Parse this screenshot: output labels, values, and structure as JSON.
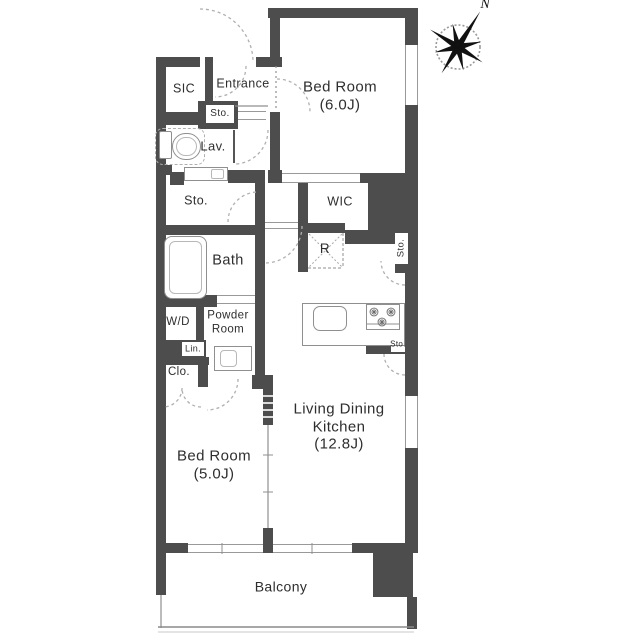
{
  "title": "apartment-floor-plan",
  "colors": {
    "wall": "#4d4d4d",
    "line": "#8f8f8f",
    "dash": "#b0b0b0",
    "text": "#2e2e2e"
  },
  "compass": {
    "cx": 458,
    "cy": 47,
    "r": 22,
    "label": "N",
    "points": [
      {
        "a": -58,
        "len": 42
      },
      {
        "a": -13,
        "len": 24
      },
      {
        "a": 32,
        "len": 29
      },
      {
        "a": 77,
        "len": 24
      },
      {
        "a": 122,
        "len": 31
      },
      {
        "a": 167,
        "len": 24
      },
      {
        "a": 212,
        "len": 33
      },
      {
        "a": 257,
        "len": 24
      }
    ],
    "half_width": 3.4
  },
  "labels": [
    {
      "name": "label-sic",
      "text": "SIC",
      "x": 184,
      "y": 89,
      "size": 12.5
    },
    {
      "name": "label-entrance",
      "text": "Entrance",
      "x": 243,
      "y": 84,
      "size": 12.5
    },
    {
      "name": "label-sto-entrance",
      "text": "Sto.",
      "x": 220,
      "y": 114,
      "size": 10
    },
    {
      "name": "label-lav",
      "text": "Lav.",
      "x": 213,
      "y": 146,
      "size": 13
    },
    {
      "name": "label-bedroom6",
      "text": "Bed Room\n(6.0J)",
      "x": 340,
      "y": 96,
      "size": 15
    },
    {
      "name": "label-sto-hall",
      "text": "Sto.",
      "x": 196,
      "y": 201,
      "size": 12.5
    },
    {
      "name": "label-wic",
      "text": "WIC",
      "x": 340,
      "y": 202,
      "size": 12.5
    },
    {
      "name": "label-refrigerator",
      "text": "R",
      "x": 325,
      "y": 249,
      "size": 13.5
    },
    {
      "name": "label-bath",
      "text": "Bath",
      "x": 228,
      "y": 261,
      "size": 14.5
    },
    {
      "name": "label-sto-right-1",
      "text": "Sto.",
      "x": 401,
      "y": 248,
      "size": 9.5,
      "rotate": true
    },
    {
      "name": "label-wd",
      "text": "W/D",
      "x": 178,
      "y": 323,
      "size": 11.5
    },
    {
      "name": "label-powder-room",
      "text": "Powder\nRoom",
      "x": 228,
      "y": 323,
      "size": 11.5
    },
    {
      "name": "label-lin",
      "text": "Lin.",
      "x": 193,
      "y": 349,
      "size": 9
    },
    {
      "name": "label-clo",
      "text": "Clo.",
      "x": 179,
      "y": 373,
      "size": 11.5
    },
    {
      "name": "label-sto-right-2",
      "text": "Sto.",
      "x": 398,
      "y": 344,
      "size": 8
    },
    {
      "name": "label-ldk",
      "text": "Living Dining\nKitchen\n(12.8J)",
      "x": 339,
      "y": 427,
      "size": 15
    },
    {
      "name": "label-bedroom5",
      "text": "Bed Room\n(5.0J)",
      "x": 214,
      "y": 465,
      "size": 15
    },
    {
      "name": "label-balcony",
      "text": "Balcony",
      "x": 281,
      "y": 587,
      "size": 14
    }
  ],
  "plan": {
    "walls": [
      [
        156,
        57,
        10,
        496
      ],
      [
        156,
        543,
        32,
        10
      ],
      [
        156,
        553,
        10,
        42
      ],
      [
        156,
        57,
        44,
        10
      ],
      [
        256,
        57,
        26,
        10
      ],
      [
        268,
        8,
        150,
        10
      ],
      [
        270,
        8,
        10,
        57
      ],
      [
        268,
        57,
        14,
        10
      ],
      [
        270,
        112,
        10,
        61
      ],
      [
        268,
        170,
        14,
        13
      ],
      [
        360,
        173,
        58,
        10
      ],
      [
        405,
        18,
        13,
        27
      ],
      [
        405,
        105,
        13,
        78
      ],
      [
        368,
        183,
        50,
        50
      ],
      [
        395,
        233,
        23,
        40
      ],
      [
        405,
        273,
        13,
        61
      ],
      [
        405,
        334,
        13,
        62
      ],
      [
        366,
        334,
        41,
        20
      ],
      [
        405,
        448,
        13,
        105
      ],
      [
        352,
        543,
        53,
        10
      ],
      [
        373,
        553,
        40,
        44
      ],
      [
        407,
        597,
        10,
        32
      ],
      [
        205,
        57,
        8,
        50
      ],
      [
        156,
        112,
        51,
        13
      ],
      [
        198,
        101,
        40,
        28
      ],
      [
        156,
        165,
        16,
        10
      ],
      [
        170,
        172,
        14,
        13
      ],
      [
        228,
        170,
        37,
        13
      ],
      [
        255,
        172,
        10,
        217
      ],
      [
        156,
        225,
        109,
        10
      ],
      [
        156,
        295,
        61,
        12
      ],
      [
        196,
        307,
        8,
        36
      ],
      [
        156,
        340,
        50,
        17
      ],
      [
        156,
        357,
        53,
        8
      ],
      [
        198,
        357,
        10,
        30
      ],
      [
        252,
        375,
        21,
        14
      ],
      [
        263,
        389,
        10,
        36
      ],
      [
        263,
        528,
        10,
        25
      ],
      [
        298,
        183,
        10,
        40
      ],
      [
        298,
        223,
        10,
        49
      ],
      [
        308,
        223,
        37,
        10
      ],
      [
        345,
        230,
        50,
        14
      ]
    ],
    "white_boxes": [
      {
        "name": "sto-entrance-box",
        "r": [
          206,
          105,
          28,
          18
        ]
      },
      {
        "name": "lin-box",
        "r": [
          182,
          342,
          22,
          14
        ]
      },
      {
        "name": "sto-right-1-box",
        "r": [
          395,
          233,
          13,
          31
        ]
      },
      {
        "name": "sto-right-2-box",
        "r": [
          391,
          337,
          14,
          15
        ]
      }
    ],
    "rails": [
      {
        "name": "opening-bedroom6-south",
        "r": [
          282,
          173,
          78,
          10
        ],
        "v": false
      },
      {
        "name": "door-sto-entrance",
        "r": [
          238,
          111,
          28,
          9
        ],
        "v": false
      },
      {
        "name": "door-bath",
        "r": [
          217,
          295,
          38,
          9
        ],
        "v": false
      },
      {
        "name": "threshold-ldk",
        "r": [
          265,
          222,
          33,
          7
        ],
        "v": false
      },
      {
        "name": "window-south-a",
        "r": [
          188,
          544,
          75,
          9
        ],
        "v": false
      },
      {
        "name": "window-south-b",
        "r": [
          273,
          544,
          79,
          9
        ],
        "v": false
      },
      {
        "name": "window-east-bedroom6",
        "r": [
          405,
          45,
          13,
          60
        ],
        "v": true
      },
      {
        "name": "window-east-ldk",
        "r": [
          405,
          396,
          13,
          52
        ],
        "v": true
      }
    ],
    "fixtures": [
      {
        "name": "bathtub",
        "r": [
          164,
          236,
          43,
          63
        ],
        "rad": 8
      },
      {
        "name": "bathtub-inner",
        "r": [
          169,
          241,
          33,
          53
        ],
        "rad": 6,
        "soft": true
      },
      {
        "name": "toilet-tank",
        "r": [
          159,
          131,
          13,
          28
        ],
        "rad": 2
      },
      {
        "name": "toilet-bowl",
        "r": [
          172,
          133,
          29,
          27
        ],
        "rad": 14
      },
      {
        "name": "toilet-bowl-inner",
        "r": [
          176,
          137,
          21,
          19
        ],
        "rad": 10,
        "soft": true
      },
      {
        "name": "toilet-clearance",
        "r": [
          155,
          128,
          50,
          37
        ],
        "rad": 8,
        "dashed": true
      },
      {
        "name": "lav-counter",
        "r": [
          184,
          167,
          44,
          14
        ]
      },
      {
        "name": "lav-sink",
        "r": [
          211,
          169,
          13,
          10
        ],
        "rad": 2,
        "soft": true
      },
      {
        "name": "vanity",
        "r": [
          214,
          346,
          38,
          25
        ]
      },
      {
        "name": "vanity-basin",
        "r": [
          220,
          350,
          17,
          17
        ],
        "rad": 4,
        "soft": true
      },
      {
        "name": "kitchen-counter",
        "r": [
          302,
          303,
          103,
          43
        ]
      },
      {
        "name": "kitchen-sink",
        "r": [
          313,
          306,
          34,
          25
        ],
        "rad": 7
      },
      {
        "name": "stove",
        "r": [
          366,
          304,
          34,
          26
        ]
      },
      {
        "name": "refrigerator-box",
        "r": [
          308,
          233,
          35,
          35
        ],
        "noborder": true
      }
    ],
    "arcs": [
      {
        "name": "door-arc-entrance",
        "cx": 200,
        "cy": 62,
        "r": 53,
        "a0": 270,
        "a1": 360
      },
      {
        "name": "door-arc-sic",
        "cx": 215,
        "cy": 66,
        "r": 31,
        "a0": 0,
        "a1": 90
      },
      {
        "name": "door-arc-lav",
        "cx": 234,
        "cy": 130,
        "r": 34,
        "a0": 0,
        "a1": 90
      },
      {
        "name": "door-arc-sto-hall",
        "cx": 258,
        "cy": 222,
        "r": 30,
        "a0": 180,
        "a1": 270
      },
      {
        "name": "door-arc-bedroom6",
        "cx": 277,
        "cy": 112,
        "r": 33,
        "a0": 270,
        "a1": 360
      },
      {
        "name": "door-arc-ldk",
        "cx": 265,
        "cy": 226,
        "r": 37,
        "a0": 0,
        "a1": 90
      },
      {
        "name": "door-arc-powder",
        "cx": 207,
        "cy": 379,
        "r": 31,
        "a0": 0,
        "a1": 90
      },
      {
        "name": "door-arc-clo-left",
        "cx": 163,
        "cy": 388,
        "r": 19,
        "a0": 0,
        "a1": 90
      },
      {
        "name": "door-arc-clo-right",
        "cx": 201,
        "cy": 388,
        "r": 19,
        "a0": 90,
        "a1": 180
      },
      {
        "name": "door-arc-sto-1",
        "cx": 405,
        "cy": 261,
        "r": 24,
        "a0": 90,
        "a1": 180
      },
      {
        "name": "door-arc-sto-2",
        "cx": 405,
        "cy": 354,
        "r": 21,
        "a0": 90,
        "a1": 180
      }
    ],
    "lines": [
      {
        "name": "genkan-step",
        "p": [
          235,
          106,
          268,
          106
        ],
        "w": 1.2
      },
      {
        "name": "lav-door-leaf",
        "p": [
          234,
          130,
          234,
          163
        ],
        "w": 2,
        "c": "#555"
      },
      {
        "name": "bedroom6-door-leaf",
        "p": [
          276,
          66,
          276,
          110
        ],
        "w": 1.2,
        "dash": "2,3"
      },
      {
        "name": "partition-track",
        "p": [
          268,
          425,
          268,
          528
        ],
        "w": 1.2
      },
      {
        "name": "partition-tick-1",
        "p": [
          263,
          455,
          273,
          455
        ],
        "w": 1
      },
      {
        "name": "partition-tick-2",
        "p": [
          263,
          492,
          273,
          492
        ],
        "w": 1
      },
      {
        "name": "stack-stripe-1",
        "p": [
          263,
          396,
          273,
          396
        ],
        "w": 1.6,
        "c": "#fff"
      },
      {
        "name": "stack-stripe-2",
        "p": [
          263,
          403,
          273,
          403
        ],
        "w": 1.6,
        "c": "#fff"
      },
      {
        "name": "stack-stripe-3",
        "p": [
          263,
          410,
          273,
          410
        ],
        "w": 1.6,
        "c": "#fff"
      },
      {
        "name": "stack-stripe-4",
        "p": [
          263,
          417,
          273,
          417
        ],
        "w": 1.6,
        "c": "#fff"
      },
      {
        "name": "r-diagonal-1",
        "p": [
          309,
          234,
          342,
          267
        ],
        "w": 1,
        "c": "#aaa",
        "dash": "2,2"
      },
      {
        "name": "r-diagonal-2",
        "p": [
          342,
          234,
          309,
          267
        ],
        "w": 1,
        "c": "#aaa",
        "dash": "2,2"
      },
      {
        "name": "r-edge-east",
        "p": [
          343,
          233,
          343,
          268
        ],
        "w": 1,
        "dash": "3,2"
      },
      {
        "name": "r-edge-south",
        "p": [
          308,
          268,
          343,
          268
        ],
        "w": 1,
        "dash": "3,2"
      },
      {
        "name": "stove-tray",
        "p": [
          366,
          324,
          400,
          324
        ],
        "w": 1
      },
      {
        "name": "window-a-tick",
        "p": [
          222,
          543,
          222,
          554
        ],
        "w": 1
      },
      {
        "name": "window-b-tick",
        "p": [
          312,
          543,
          312,
          554
        ],
        "w": 1
      },
      {
        "name": "balcony-edge-left",
        "p": [
          161,
          595,
          161,
          628
        ],
        "w": 1.2
      },
      {
        "name": "balcony-edge-bottom",
        "p": [
          158,
          627,
          414,
          627
        ],
        "w": 1.5,
        "c": "#8a8a8a"
      },
      {
        "name": "balcony-edge-lower",
        "p": [
          158,
          632,
          414,
          632
        ],
        "w": 1,
        "c": "#c9c9c9"
      }
    ],
    "burners": [
      [
        374,
        312
      ],
      [
        391,
        312
      ],
      [
        382,
        322
      ]
    ]
  }
}
